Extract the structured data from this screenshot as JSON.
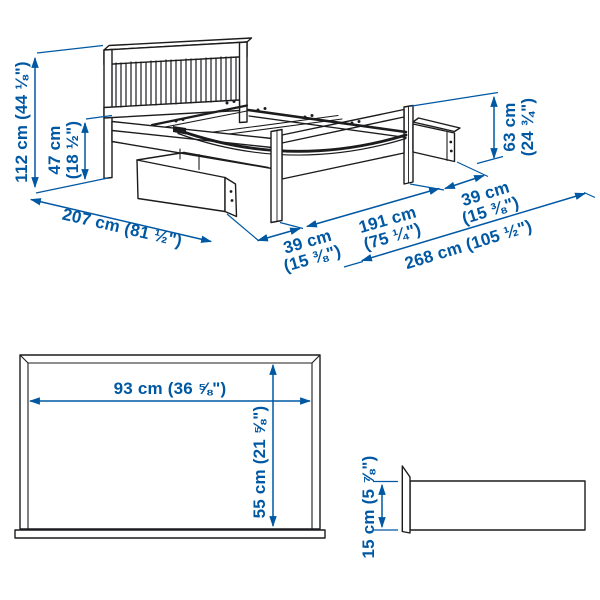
{
  "style": {
    "dimension_color": "#0058a3",
    "line_color": "#1c1c1e",
    "background": "#ffffff"
  },
  "bed_view": {
    "total_height": "112 cm (44 ⅛\")",
    "under_bed_height": {
      "metric": "47 cm",
      "imperial": "(18 ½\")"
    },
    "length": "207 cm (81 ½\")",
    "front_drawer_extension": {
      "metric": "39 cm",
      "imperial": "(15 ⅜\")"
    },
    "width": {
      "metric": "191 cm",
      "imperial": "(75 ¼\")"
    },
    "side_drawer_extension": {
      "metric": "39 cm",
      "imperial": "(15 ⅜\")"
    },
    "total_width_with_drawers": "268 cm (105 ½\")",
    "footboard_height": {
      "metric": "63 cm",
      "imperial": "(24 ¾\")"
    }
  },
  "box_front_view": {
    "width": "93 cm (36 ⅝\")",
    "height": "55 cm (21 ⅝\")"
  },
  "box_side_view": {
    "height": "15 cm (5 ⅞\")"
  }
}
